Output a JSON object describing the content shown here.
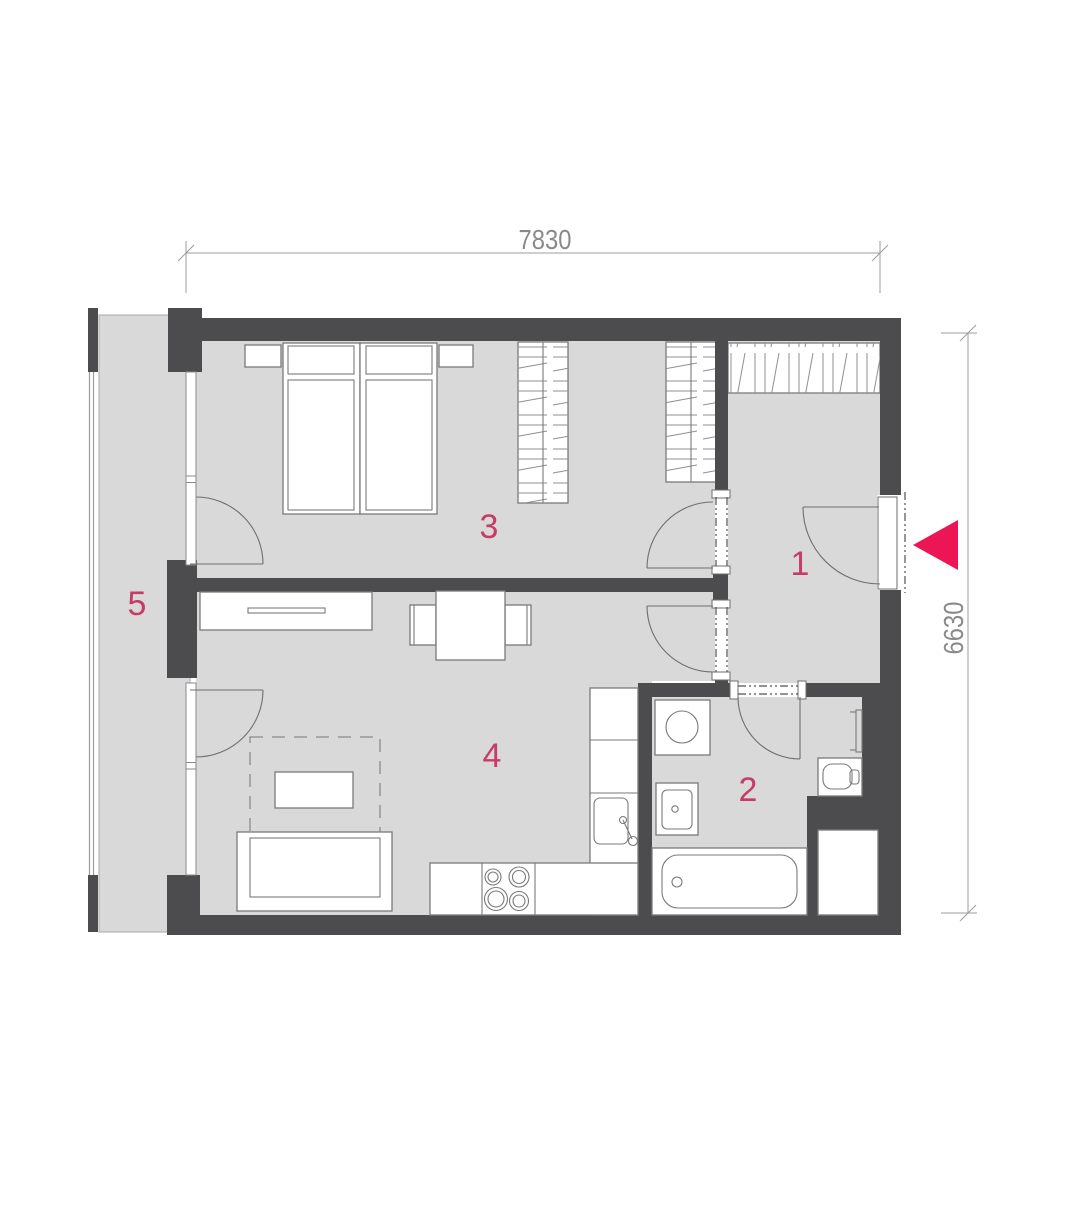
{
  "title": "apartment-floor-plan",
  "rooms": {
    "hall": {
      "number": "1"
    },
    "bathroom": {
      "number": "2"
    },
    "bedroom": {
      "number": "3"
    },
    "living_kitchen": {
      "number": "4"
    },
    "balcony": {
      "number": "5"
    }
  },
  "dimensions": {
    "top_width_mm": "7830",
    "right_height_mm": "6630"
  },
  "markers": {
    "entrance_arrow": "left-pointing-triangle"
  },
  "colors": {
    "wall": "#4c4c4e",
    "floor": "#d9d9d9",
    "accent_pink": "#ec1656",
    "room_number": "#c63c66",
    "dimension_gray": "#9c9c9c"
  },
  "furniture_icons": [
    "double-bed-icon",
    "nightstand-icon",
    "wardrobe-icon",
    "hall-closet-icon",
    "sideboard-icon",
    "dining-table-icon",
    "chair-icon",
    "sofa-icon",
    "coffee-table-icon",
    "rug-outline-icon",
    "kitchen-counter-icon",
    "cooktop-icon",
    "kitchen-sink-icon",
    "washing-machine-icon",
    "washbasin-icon",
    "bathtub-icon",
    "toilet-icon",
    "towel-radiator-icon",
    "shaft-icon",
    "door-swing-icon",
    "window-icon",
    "railing-icon"
  ]
}
